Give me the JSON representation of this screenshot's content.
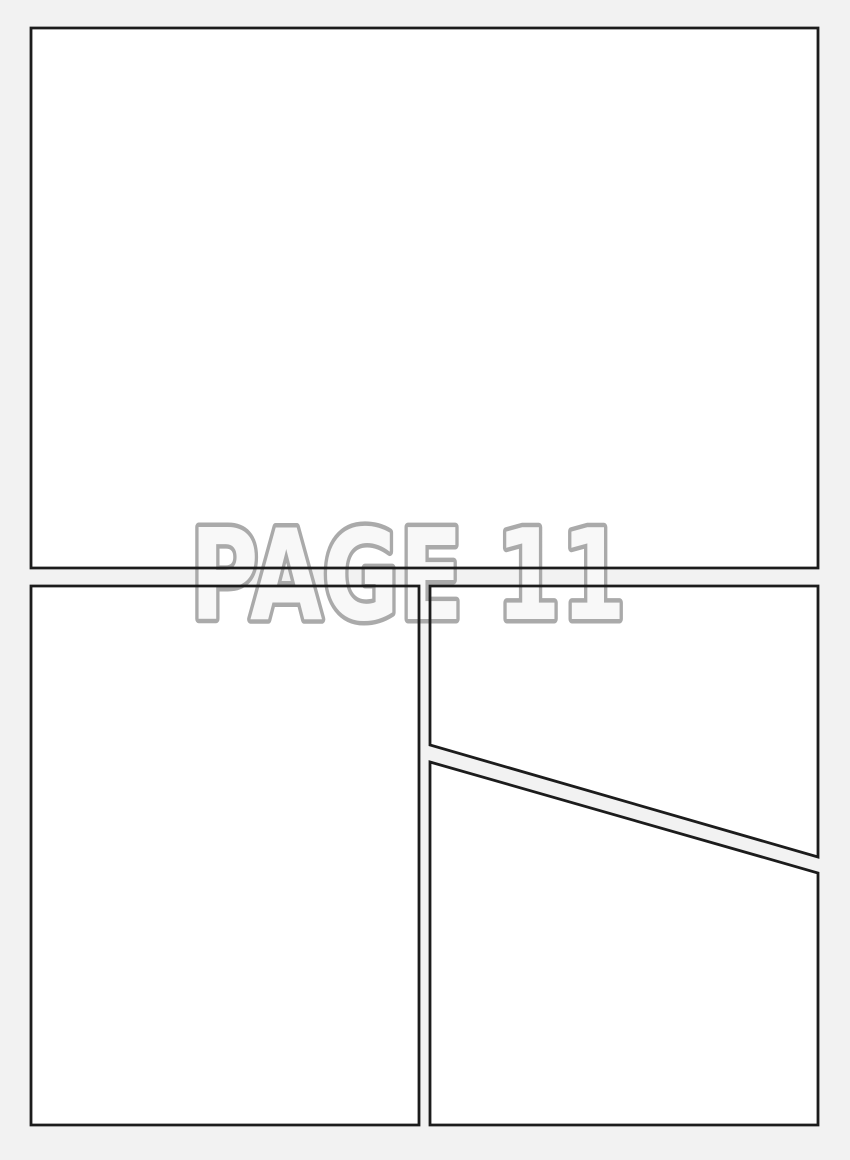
{
  "page": {
    "title": "PAGE 11"
  },
  "panels": [
    {
      "id": "panel-1",
      "shape": "rectangle",
      "position": "top, full width"
    },
    {
      "id": "panel-2",
      "shape": "rectangle",
      "position": "bottom left, tall"
    },
    {
      "id": "panel-3",
      "shape": "quadrilateral",
      "position": "right upper, diagonal bottom edge"
    },
    {
      "id": "panel-4",
      "shape": "quadrilateral",
      "position": "right lower, diagonal top edge"
    }
  ],
  "colors": {
    "background": "#f2f2f2",
    "panel_fill": "#ffffff",
    "panel_border": "#1c1c1c",
    "title_fill": "#f8f8f8",
    "title_stroke": "#aaaaaa"
  }
}
